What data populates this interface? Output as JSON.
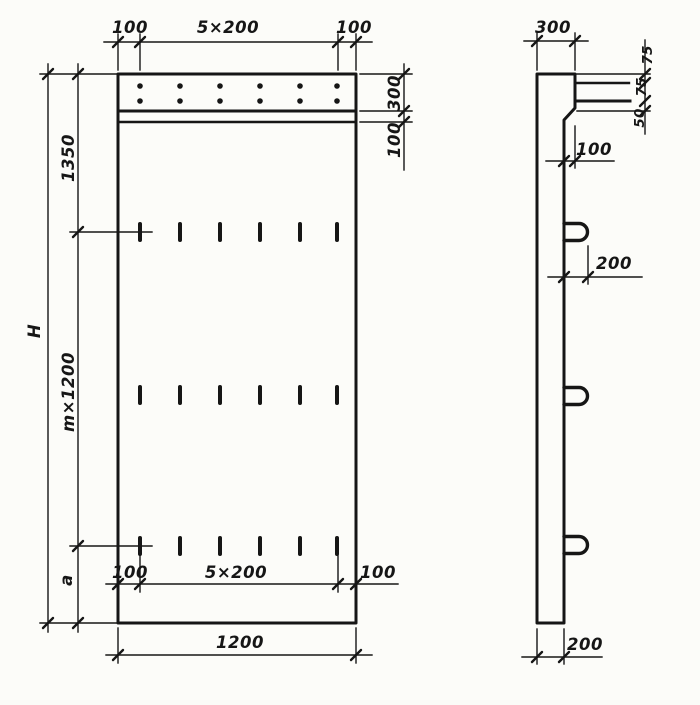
{
  "palette": {
    "ink": "#161616",
    "paper": "#fcfcf9"
  },
  "front_view": {
    "top_dims": {
      "left_offset": "100",
      "spacing": "5×200",
      "right_offset": "100"
    },
    "right_dims": {
      "top_band_height": "300",
      "lip_height": "100"
    },
    "left_dims": {
      "overall_height": "H",
      "top_section": "1350",
      "middle_section": "m×1200",
      "bottom_section": "a"
    },
    "bottom_dims": {
      "left_offset": "100",
      "spacing": "5×200",
      "right_offset": "100",
      "overall_width": "1200"
    }
  },
  "side_view": {
    "top_width": "300",
    "edge_chain": {
      "top": "75",
      "middle": "75",
      "bottom": "50"
    },
    "ledge_offset": "100",
    "loop_offset": "200",
    "panel_thickness": "200"
  }
}
